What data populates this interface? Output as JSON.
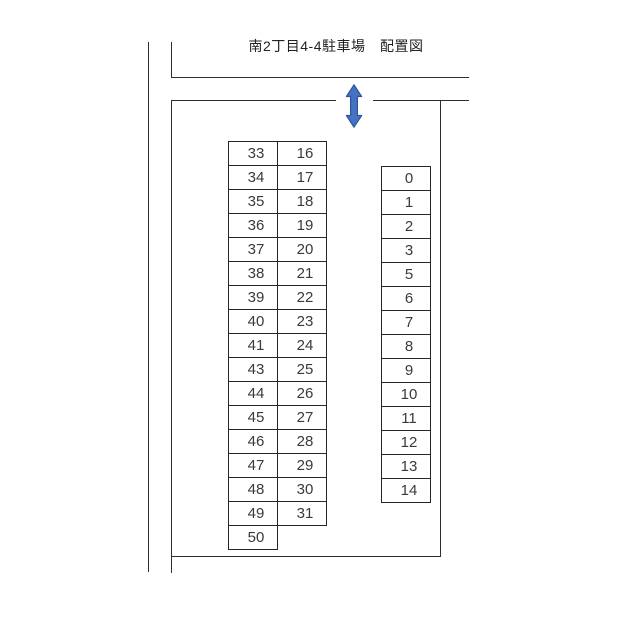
{
  "title": "南2丁目4-4駐車場　配置図",
  "diagram": {
    "left_block": {
      "description": "two-column parking space block",
      "rows": [
        [
          "33",
          "16"
        ],
        [
          "34",
          "17"
        ],
        [
          "35",
          "18"
        ],
        [
          "36",
          "19"
        ],
        [
          "37",
          "20"
        ],
        [
          "38",
          "21"
        ],
        [
          "39",
          "22"
        ],
        [
          "40",
          "23"
        ],
        [
          "41",
          "24"
        ],
        [
          "43",
          "25"
        ],
        [
          "44",
          "26"
        ],
        [
          "45",
          "27"
        ],
        [
          "46",
          "28"
        ],
        [
          "47",
          "29"
        ],
        [
          "48",
          "30"
        ],
        [
          "49",
          "31"
        ],
        [
          "50",
          null
        ]
      ]
    },
    "right_block": {
      "description": "single-column parking space block",
      "cells": [
        "0",
        "1",
        "2",
        "3",
        "5",
        "6",
        "7",
        "8",
        "9",
        "10",
        "11",
        "12",
        "13",
        "14"
      ]
    },
    "entrance_arrow": {
      "meaning": "two-way entrance arrow"
    },
    "colors": {
      "background": "#ffffff",
      "line": "#2d2d2d",
      "cell_border": "#262626",
      "text": "#3a3a3a",
      "arrow_fill": "#4472c4",
      "arrow_stroke": "#2f5597"
    }
  }
}
